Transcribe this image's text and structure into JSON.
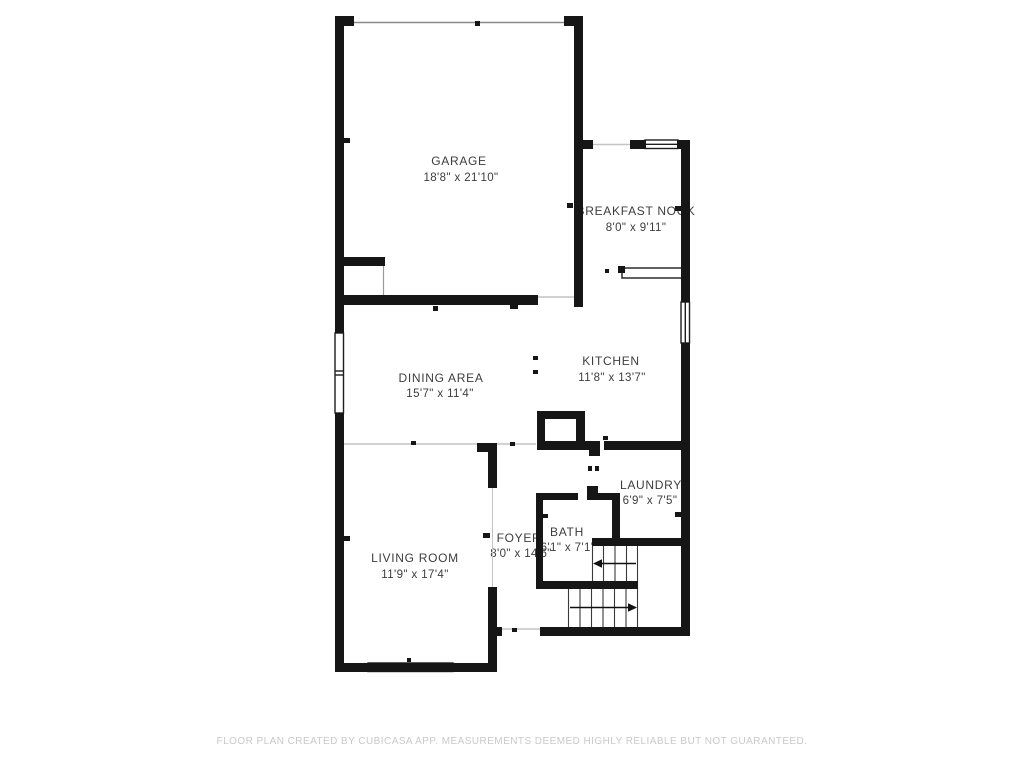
{
  "plan": {
    "rooms": {
      "garage": {
        "name": "GARAGE",
        "dims": "18'8\" x 21'10\""
      },
      "breakfast_nook": {
        "name": "BREAKFAST NOOK",
        "dims": "8'0\" x 9'11\""
      },
      "kitchen": {
        "name": "KITCHEN",
        "dims": "11'8\" x 13'7\""
      },
      "dining": {
        "name": "DINING AREA",
        "dims": "15'7\" x 11'4\""
      },
      "living": {
        "name": "LIVING ROOM",
        "dims": "11'9\" x 17'4\""
      },
      "foyer": {
        "name": "FOYER",
        "dims": "8'0\" x 14'6\""
      },
      "bath": {
        "name": "BATH",
        "dims": "6'1\" x 7'1\""
      },
      "laundry": {
        "name": "LAUNDRY",
        "dims": "6'9\" x 7'5\""
      }
    },
    "features": [
      "staircase-up-arrows",
      "windows",
      "garage-door",
      "kitchen-counter"
    ]
  },
  "footer": {
    "disclaimer": "FLOOR PLAN CREATED BY CUBICASA APP. MEASUREMENTS DEEMED HIGHLY RELIABLE BUT NOT GUARANTEED."
  },
  "colors": {
    "wall": "#161616",
    "label_text": "#3d3d3d",
    "footer_text": "#c9c9c9",
    "background": "#ffffff",
    "opening_line": "#c4c4c4"
  }
}
